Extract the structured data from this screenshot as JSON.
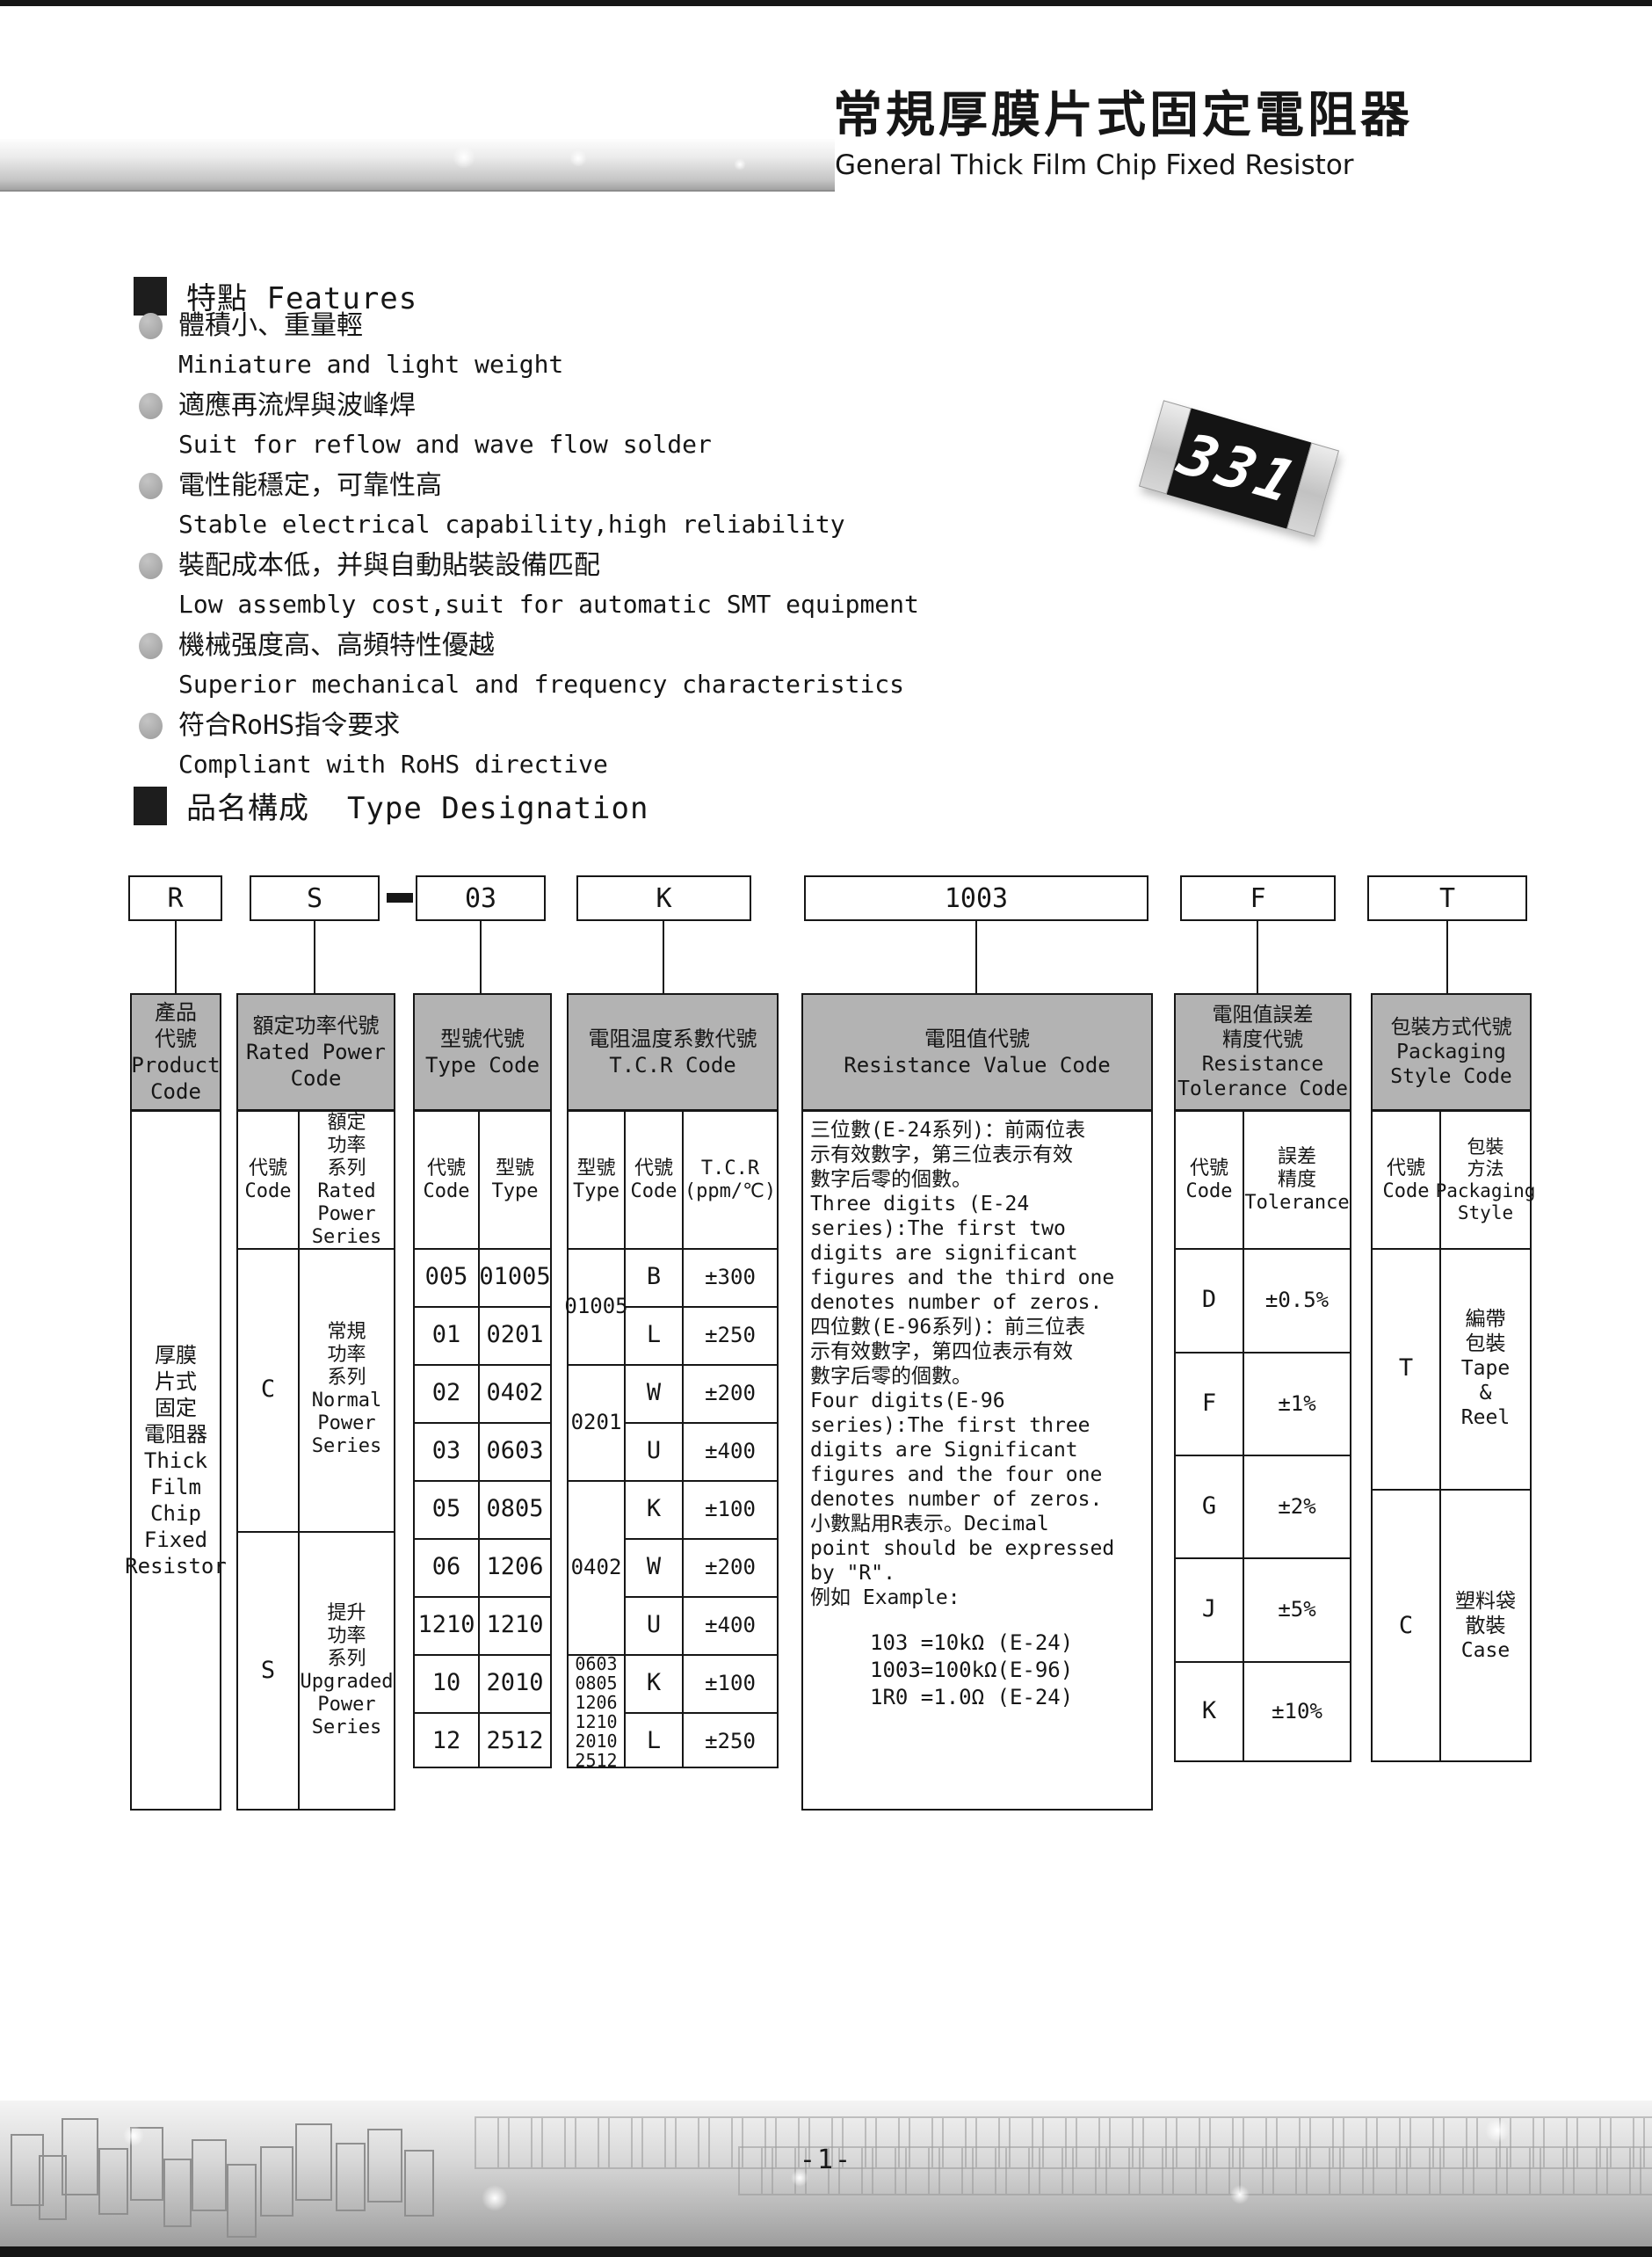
{
  "page": {
    "title_zh": "常規厚膜片式固定電阻器",
    "title_en": "General Thick Film Chip Fixed Resistor",
    "page_number": "-1-"
  },
  "features": {
    "heading_zh": "特點",
    "heading_en": "Features",
    "items": [
      {
        "zh": "體積小、重量輕",
        "en": "Miniature and light weight"
      },
      {
        "zh": "適應再流焊與波峰焊",
        "en": "Suit for reflow and wave flow solder"
      },
      {
        "zh": "電性能穩定，可靠性高",
        "en": "Stable electrical capability,high reliability"
      },
      {
        "zh": "裝配成本低，并與自動貼裝設備匹配",
        "en": "Low assembly cost,suit for automatic SMT equipment"
      },
      {
        "zh": "機械强度高、高頻特性優越",
        "en": "Superior mechanical and frequency characteristics"
      },
      {
        "zh": "符合RoHS指令要求",
        "en": "Compliant with RoHS directive"
      }
    ]
  },
  "chip": {
    "marking": "331"
  },
  "designation": {
    "heading_zh": "品名構成",
    "heading_en": "Type Designation",
    "codes": {
      "product": "R",
      "power": "S",
      "type": "03",
      "tcr": "K",
      "value": "1003",
      "tolerance": "F",
      "packaging": "T"
    }
  },
  "table": {
    "product": {
      "header": "產品\n代號\nProduct\nCode",
      "body": "厚膜\n片式\n固定\n電阻器\nThick\nFilm\nChip\nFixed\nResistor"
    },
    "power": {
      "header": "額定功率代號\nRated Power\nCode",
      "sub_code": "代號\nCode",
      "sub_series": "額定\n功率\n系列\nRated\nPower\nSeries",
      "rows": [
        {
          "code": "C",
          "series": "常規\n功率\n系列\nNormal\nPower\nSeries"
        },
        {
          "code": "S",
          "series": "提升\n功率\n系列\nUpgraded\nPower\nSeries"
        }
      ]
    },
    "type": {
      "header": "型號代號\nType Code",
      "sub_code": "代號\nCode",
      "sub_type": "型號\nType",
      "rows": [
        {
          "code": "005",
          "type": "01005"
        },
        {
          "code": "01",
          "type": "0201"
        },
        {
          "code": "02",
          "type": "0402"
        },
        {
          "code": "03",
          "type": "0603"
        },
        {
          "code": "05",
          "type": "0805"
        },
        {
          "code": "06",
          "type": "1206"
        },
        {
          "code": "1210",
          "type": "1210"
        },
        {
          "code": "10",
          "type": "2010"
        },
        {
          "code": "12",
          "type": "2512"
        }
      ]
    },
    "tcr": {
      "header": "電阻温度系數代號\nT.C.R Code",
      "sub_type": "型號\nType",
      "sub_code": "代號\nCode",
      "sub_value": "T.C.R\n(ppm/℃)",
      "groups": [
        {
          "type": "01005",
          "rows": [
            {
              "code": "B",
              "tcr": "±300"
            },
            {
              "code": "L",
              "tcr": "±250"
            }
          ]
        },
        {
          "type": "0201",
          "rows": [
            {
              "code": "W",
              "tcr": "±200"
            },
            {
              "code": "U",
              "tcr": "±400"
            }
          ]
        },
        {
          "type": "0402",
          "rows": [
            {
              "code": "K",
              "tcr": "±100"
            },
            {
              "code": "W",
              "tcr": "±200"
            },
            {
              "code": "U",
              "tcr": "±400"
            }
          ]
        },
        {
          "type": "0603\n0805\n1206\n1210\n2010\n2512",
          "rows": [
            {
              "code": "K",
              "tcr": "±100"
            },
            {
              "code": "L",
              "tcr": "±250"
            }
          ]
        }
      ]
    },
    "value": {
      "header": "電阻值代號\nResistance Value Code",
      "description": "三位數(E-24系列)：前兩位表\n示有效數字，第三位表示有效\n數字后零的個數。\nThree digits (E-24\nseries):The first two\ndigits are significant\nfigures and the third one\ndenotes number of zeros.\n四位數(E-96系列)：前三位表\n示有效數字，第四位表示有效\n數字后零的個數。\nFour digits(E-96\nseries):The first three\ndigits are Significant\nfigures and the four one\ndenotes number of zeros.\n小數點用R表示。Decimal\npoint should be expressed\nby \"R\".\n例如 Example:",
      "examples": "103 =10kΩ (E-24)\n1003=100kΩ(E-96)\n1R0 =1.0Ω (E-24)"
    },
    "tolerance": {
      "header": "電阻值誤差\n精度代號\nResistance\nTolerance Code",
      "sub_code": "代號\nCode",
      "sub_tol": "誤差\n精度\nTolerance",
      "rows": [
        {
          "code": "D",
          "tol": "±0.5%"
        },
        {
          "code": "F",
          "tol": "±1%"
        },
        {
          "code": "G",
          "tol": "±2%"
        },
        {
          "code": "J",
          "tol": "±5%"
        },
        {
          "code": "K",
          "tol": "±10%"
        }
      ]
    },
    "packaging": {
      "header": "包裝方式代號\nPackaging\nStyle Code",
      "sub_code": "代號\nCode",
      "sub_style": "包裝\n方法\nPackaging\nStyle",
      "rows": [
        {
          "code": "T",
          "style": "編帶\n包裝\nTape\n&\nReel"
        },
        {
          "code": "C",
          "style": "塑料袋\n散裝\nCase"
        }
      ]
    }
  }
}
